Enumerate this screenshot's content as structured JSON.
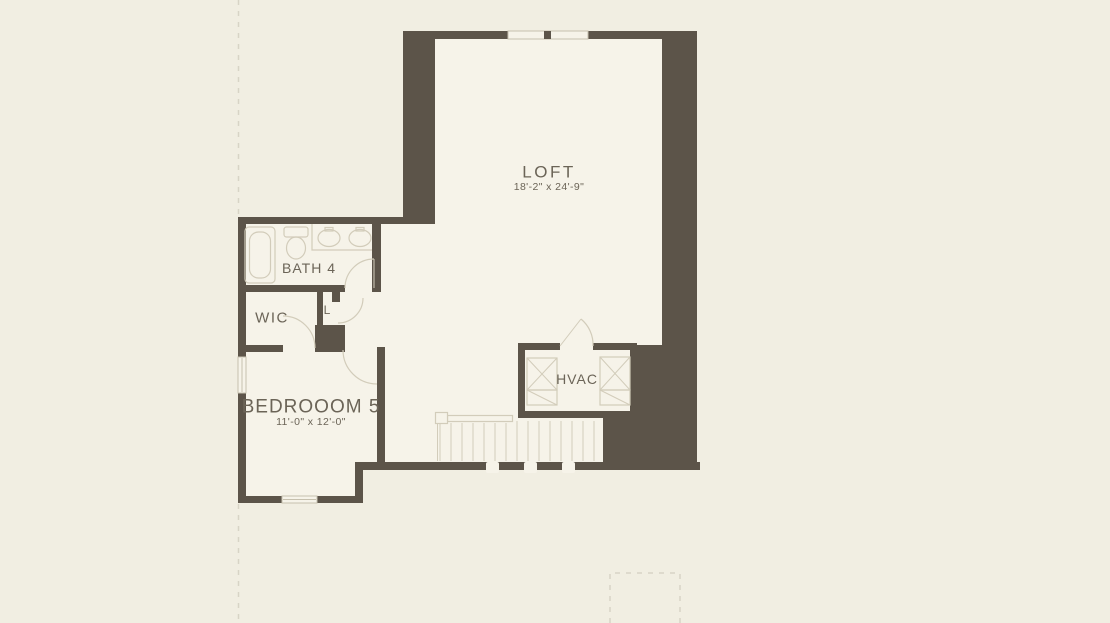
{
  "plan_title": "Second floor residential floor plan",
  "rooms": {
    "loft": {
      "label": "LOFT",
      "dims": "18'-2\" x 24'-9\""
    },
    "bath": {
      "label": "BATH 4",
      "dims": ""
    },
    "wic": {
      "label": "WIC",
      "dims": ""
    },
    "linen": {
      "label": "L",
      "dims": ""
    },
    "bedroom": {
      "label": "BEDROOOM 5",
      "dims": "11'-0\" x 12'-0\""
    },
    "hvac": {
      "label": "HVAC",
      "dims": ""
    }
  },
  "colors": {
    "bg": "#f1eee2",
    "interior": "#f6f3e9",
    "wall": "#5c5449",
    "line": "#d2ccba",
    "window-line": "#c6c0ae",
    "text": "#6b6457",
    "dash": "#d8d4c6"
  }
}
